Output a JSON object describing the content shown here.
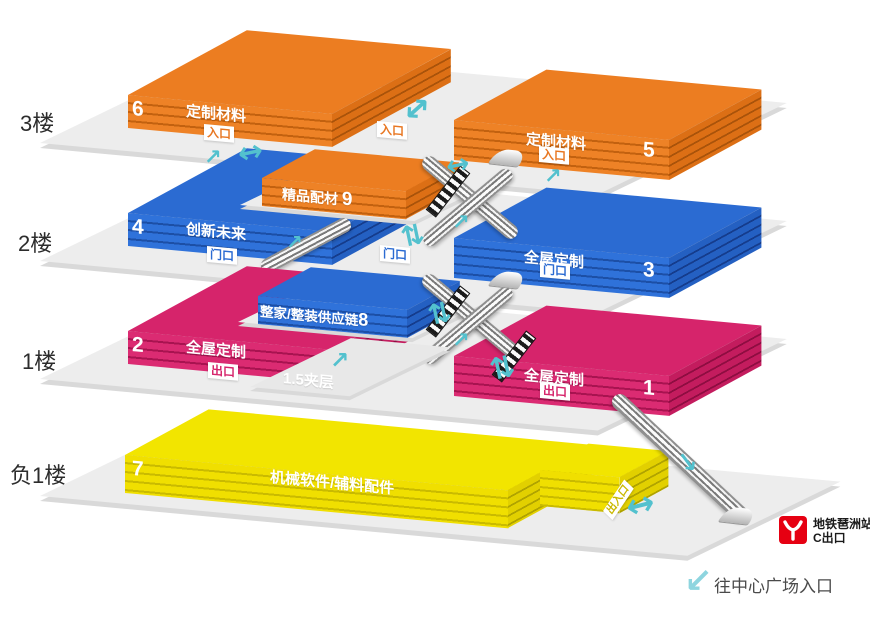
{
  "floors": [
    {
      "label": "3楼",
      "mid_door": "入口",
      "blocks": [
        {
          "num": "6",
          "name": "定制材料",
          "door": "入口"
        },
        {
          "num": "5",
          "name": "定制材料",
          "door": "入口"
        }
      ]
    },
    {
      "label": "2楼",
      "mid_door": "门口",
      "blocks": [
        {
          "num": "4",
          "name": "创新未来",
          "door": "门口"
        },
        {
          "num": "3",
          "name": "全屋定制",
          "door": "门口"
        }
      ]
    },
    {
      "label": "1楼",
      "mezzanine_label": "1.5夹层",
      "blocks": [
        {
          "num": "2",
          "name": "全屋定制",
          "door": "出口"
        },
        {
          "num": "1",
          "name": "全屋定制",
          "door": "出口"
        }
      ]
    },
    {
      "label": "负1楼",
      "blocks": [
        {
          "num": "7",
          "name": "机械软件/辅料配件",
          "door": "出入口"
        }
      ]
    }
  ],
  "mid_blocks": [
    {
      "num": "9",
      "name": "精品配材"
    },
    {
      "num": "8",
      "name": "整家/整装供应链"
    }
  ],
  "metro": {
    "station": "地铁琶洲站",
    "exit": "C出口"
  },
  "plaza_note": "往中心广场入口",
  "icons": {
    "up_right": "↗",
    "down_right": "↘",
    "down_left": "↙",
    "double_h": "↔",
    "double_v": "⇅"
  },
  "colors": {
    "orange": "#EC7D21",
    "blue": "#2B6BD2",
    "pink": "#D6246B",
    "yellow": "#F2E500",
    "teal": "#53C1CE",
    "teal_light": "#8ED5DF",
    "metro_red": "#E60012",
    "platform": "#EDEDED"
  }
}
